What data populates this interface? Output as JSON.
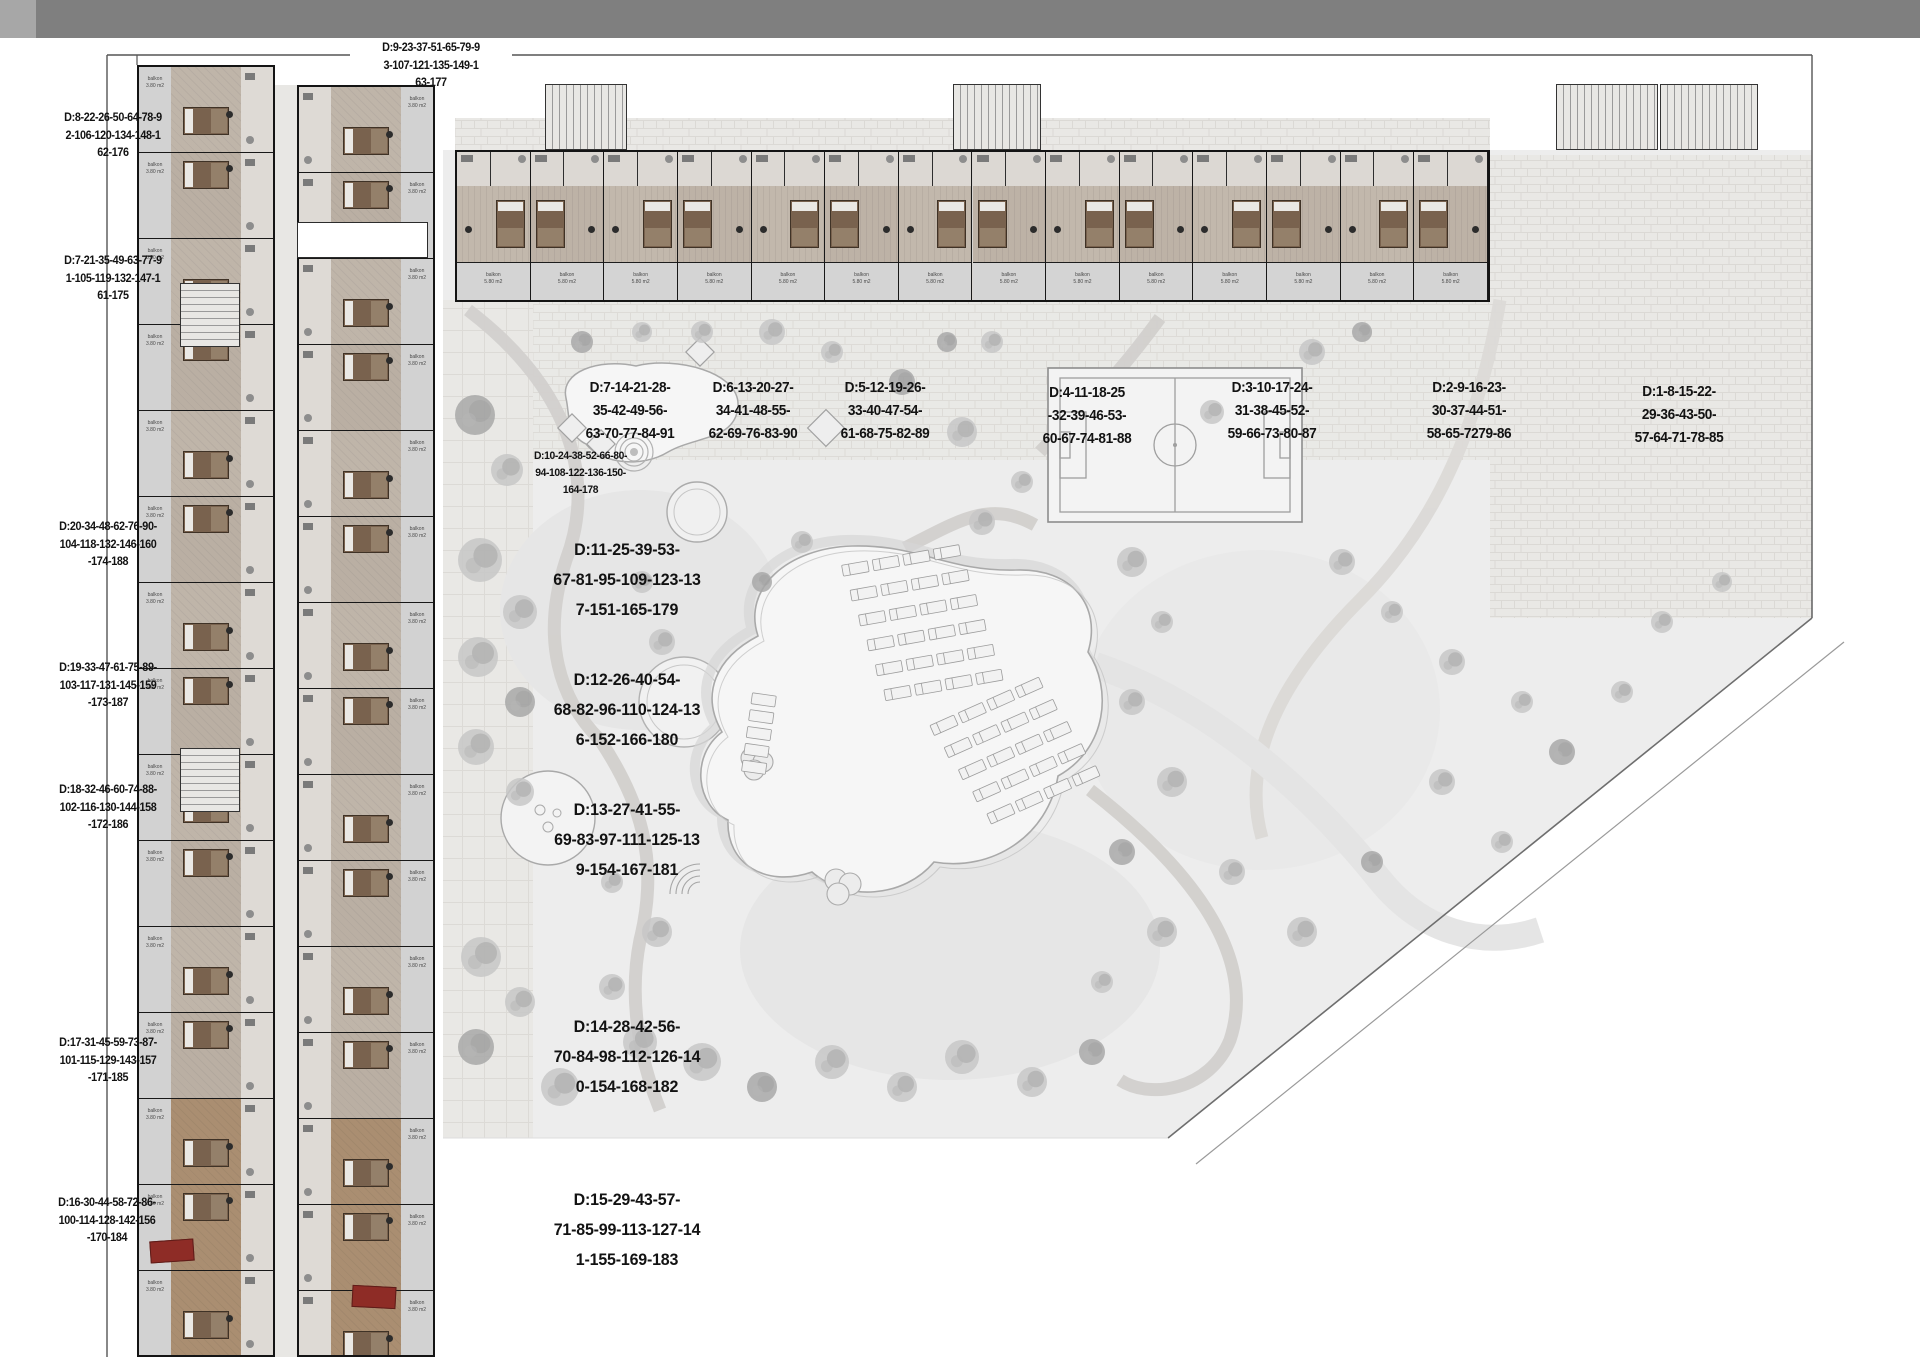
{
  "labels": {
    "top": {
      "lines": [
        "D:9-23-37-51-65-79-9",
        "3-107-121-135-149-1",
        "63-177"
      ]
    },
    "left": [
      {
        "lines": [
          "D:8-22-26-50-64-78-9",
          "2-106-120-134-148-1",
          "62-176"
        ]
      },
      {
        "lines": [
          "D:7-21-35-49-63-77-9",
          "1-105-119-132-147-1",
          "61-175"
        ]
      },
      {
        "lines": [
          "D:20-34-48-62-76-90-",
          "104-118-132-146-160",
          "-174-188"
        ]
      },
      {
        "lines": [
          "D:19-33-47-61-75-89-",
          "103-117-131-145-159",
          "-173-187"
        ]
      },
      {
        "lines": [
          "D:18-32-46-60-74-88-",
          "102-116-130-144-158",
          "-172-186"
        ]
      },
      {
        "lines": [
          "D:17-31-45-59-73-87-",
          "101-115-129-143-157",
          "-171-185"
        ]
      },
      {
        "lines": [
          "D:16-30-44-58-72-86-",
          "100-114-128-142-156",
          "-170-184"
        ]
      }
    ],
    "mid_small": {
      "lines": [
        "D:10-24-38-52-66-80-",
        "94-108-122-136-150-",
        "164-178"
      ]
    },
    "mid_large": [
      {
        "lines": [
          "D:11-25-39-53-",
          "67-81-95-109-123-13",
          "7-151-165-179"
        ]
      },
      {
        "lines": [
          "D:12-26-40-54-",
          "68-82-96-110-124-13",
          "6-152-166-180"
        ]
      },
      {
        "lines": [
          "D:13-27-41-55-",
          "69-83-97-111-125-13",
          "9-154-167-181"
        ]
      },
      {
        "lines": [
          "D:14-28-42-56-",
          "70-84-98-112-126-14",
          "0-154-168-182"
        ]
      },
      {
        "lines": [
          "D:15-29-43-57-",
          "71-85-99-113-127-14",
          "1-155-169-183"
        ]
      }
    ],
    "top_row": [
      {
        "lines": [
          "D:7-14-21-28-",
          "35-42-49-56-",
          "63-70-77-84-91"
        ]
      },
      {
        "lines": [
          "D:6-13-20-27-",
          "34-41-48-55-",
          "62-69-76-83-90"
        ]
      },
      {
        "lines": [
          "D:5-12-19-26-",
          "33-40-47-54-",
          "61-68-75-82-89"
        ]
      },
      {
        "lines": [
          "D:4-11-18-25",
          "-32-39-46-53-",
          "60-67-74-81-88"
        ]
      },
      {
        "lines": [
          "D:3-10-17-24-",
          "31-38-45-52-",
          "59-66-73-80-87"
        ]
      },
      {
        "lines": [
          "D:2-9-16-23-",
          "30-37-44-51-",
          "58-65-7279-86"
        ]
      },
      {
        "lines": [
          "D:1-8-15-22-",
          "29-36-43-50-",
          "57-64-71-78-85"
        ]
      }
    ]
  },
  "room_labels": {
    "balcony": "balkon",
    "area_small": "3.80 m2",
    "area_large": "5.80 m2"
  },
  "colors": {
    "topbar": "#7f7f7f",
    "wall": "#141414",
    "landscape": "#ededed",
    "pavement": "#e9e8e5",
    "pool_line": "#a9a9a9",
    "tree": "#c7c7c7",
    "wood": "#79624e",
    "sofa_red": "#8e2c26"
  }
}
